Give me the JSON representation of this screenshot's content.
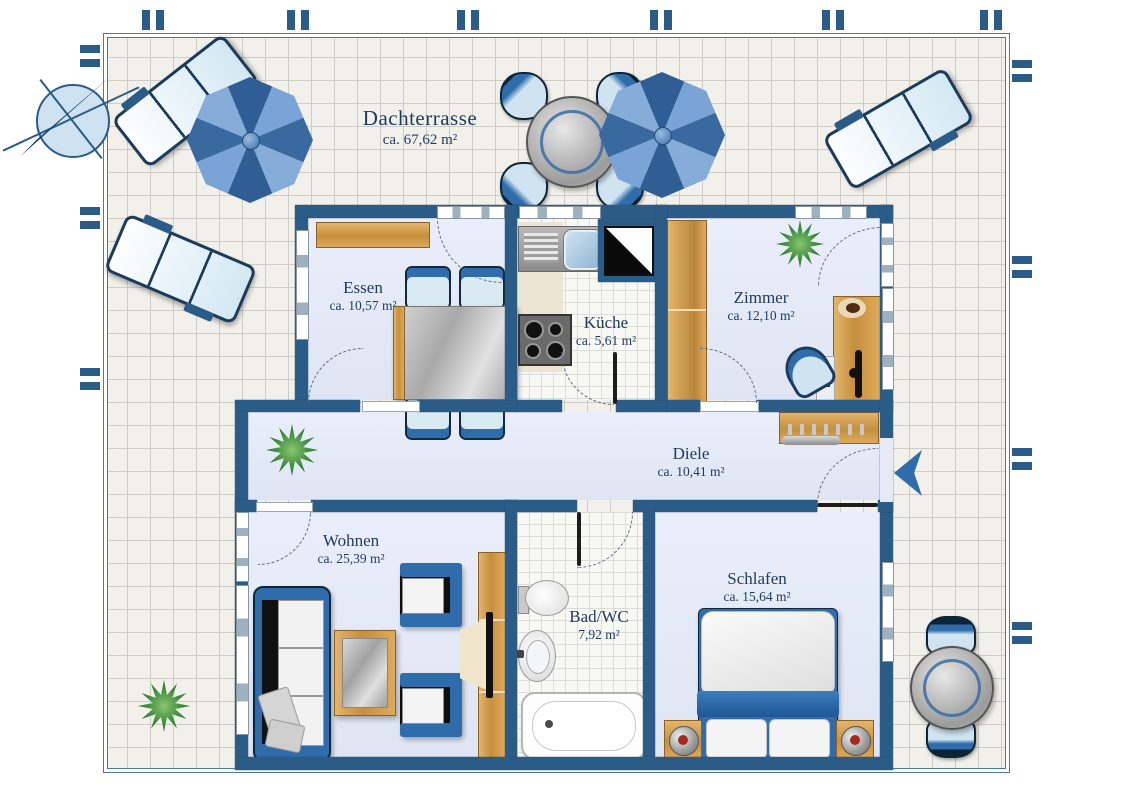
{
  "terrace": {
    "name": "Dachterrasse",
    "area": "ca. 67,62 m²"
  },
  "rooms": {
    "essen": {
      "name": "Essen",
      "area": "ca. 10,57 m²"
    },
    "kueche": {
      "name": "Küche",
      "area": "ca. 5,61 m²"
    },
    "zimmer": {
      "name": "Zimmer",
      "area": "ca. 12,10 m²"
    },
    "diele": {
      "name": "Diele",
      "area": "ca. 10,41 m²"
    },
    "wohnen": {
      "name": "Wohnen",
      "area": "ca. 25,39 m²"
    },
    "bad": {
      "name": "Bad/WC",
      "area": "7,92 m²"
    },
    "schlafen": {
      "name": "Schlafen",
      "area": "ca. 15,64 m²"
    }
  },
  "colors": {
    "wall": "#2b5c88",
    "floor": "#e6eaf7",
    "accent_blue": "#2e6cab",
    "wood": "#cf9a52",
    "terrace_tile": "#f1f0ea",
    "text": "#1e3a5f"
  }
}
